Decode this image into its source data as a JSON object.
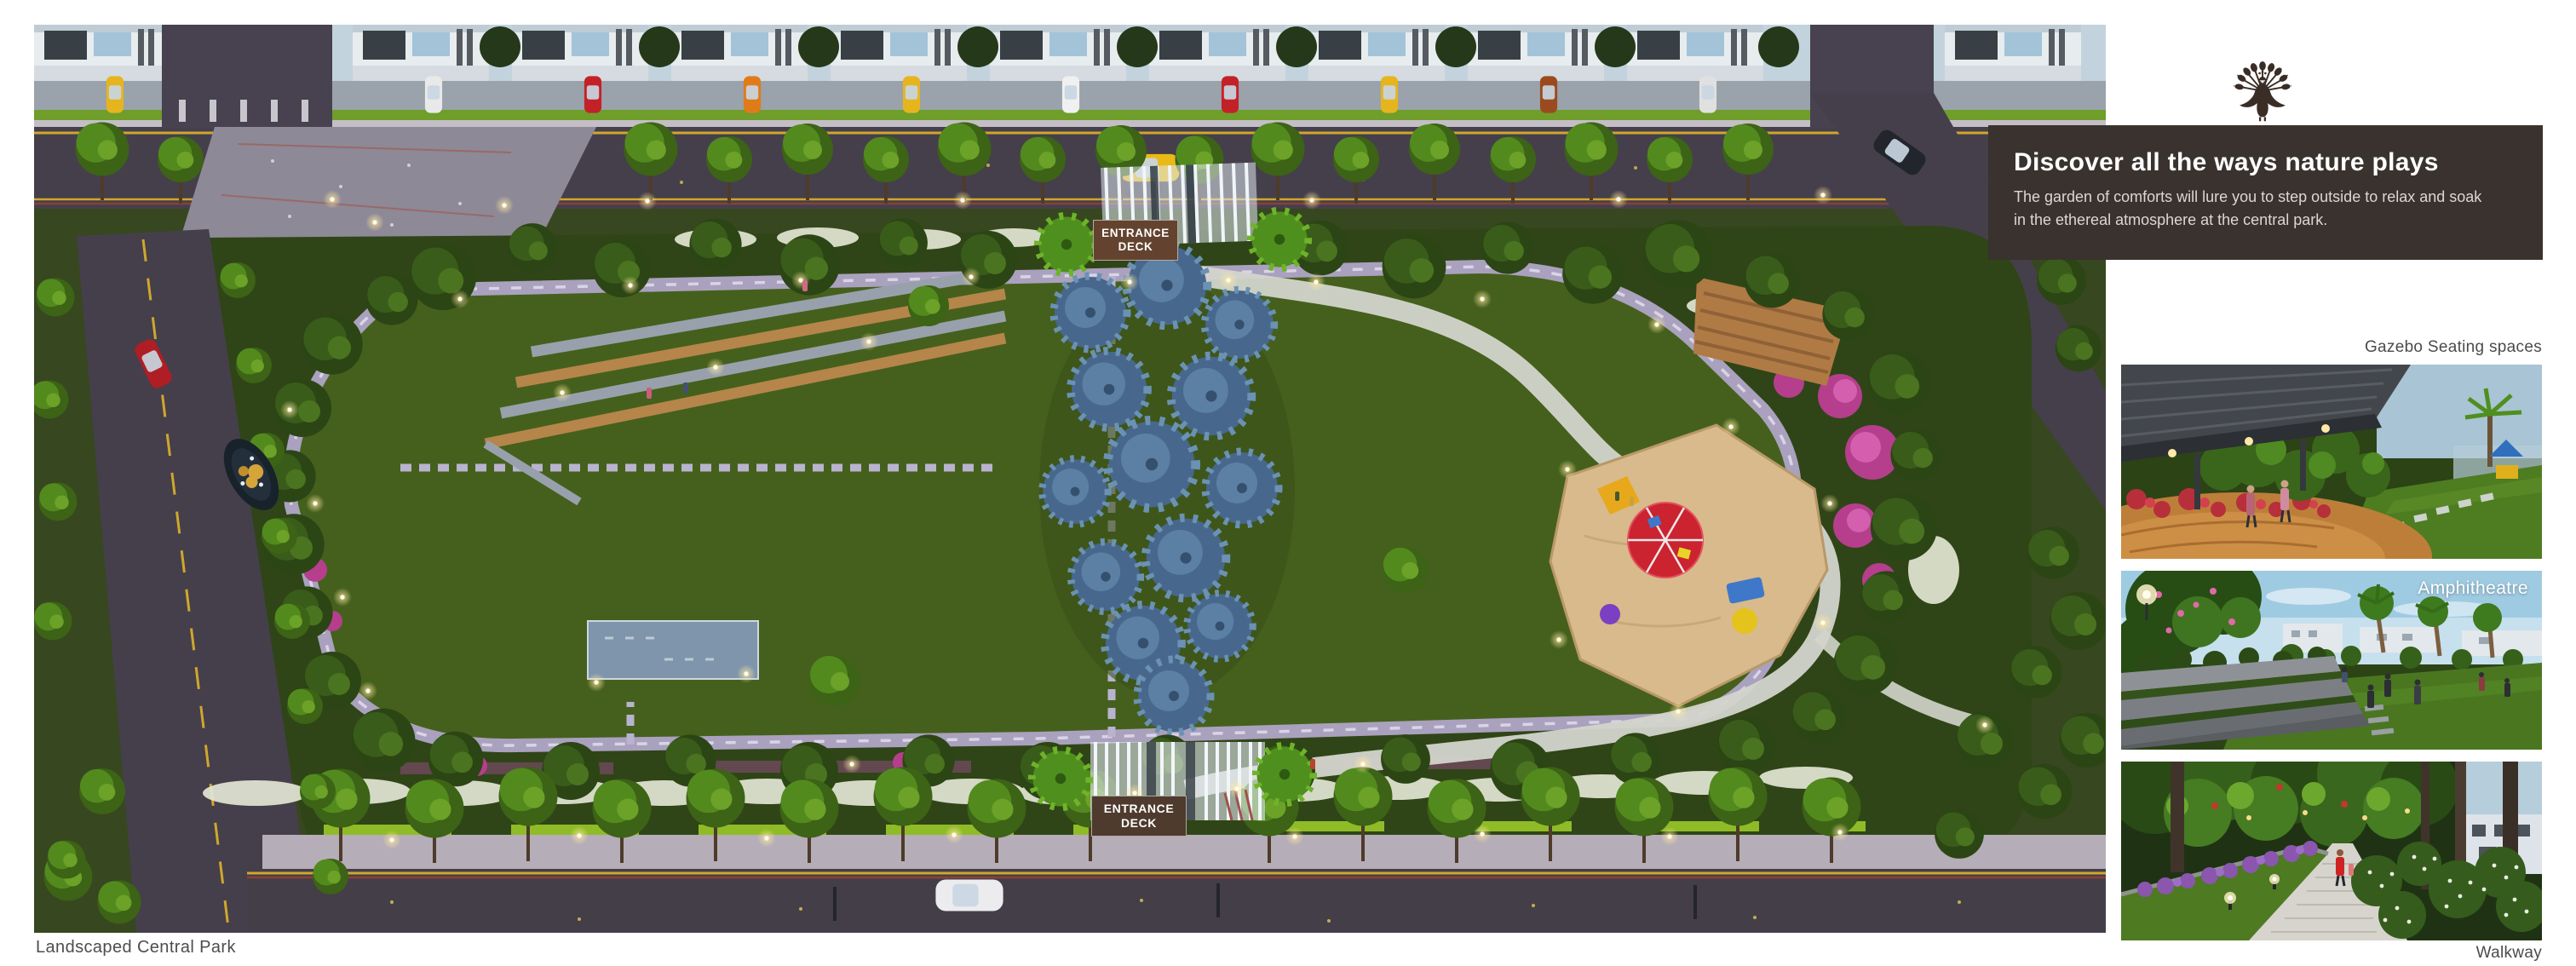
{
  "page": {
    "background": "#ffffff"
  },
  "hero": {
    "caption": "Landscaped Central Park",
    "entrance_sign": {
      "line1": "ENTRANCE",
      "line2": "DECK"
    }
  },
  "logo": {
    "icon": "peacock-emblem",
    "color": "#3a2d26"
  },
  "callout": {
    "title": "Discover all the ways nature plays",
    "body_line1": "The garden of comforts will lure you to step outside to relax and soak",
    "body_line2": "in the ethereal atmosphere at the central park.",
    "background": "#3a322e",
    "title_color": "#ffffff",
    "body_color": "#ddd7d2"
  },
  "gallery": {
    "items": [
      {
        "label": "Gazebo Seating spaces"
      },
      {
        "label": "Amphitheatre"
      },
      {
        "label": "Walkway"
      }
    ],
    "label_color": "#4b4b4b",
    "overlay_label_color": "#ffffff"
  }
}
